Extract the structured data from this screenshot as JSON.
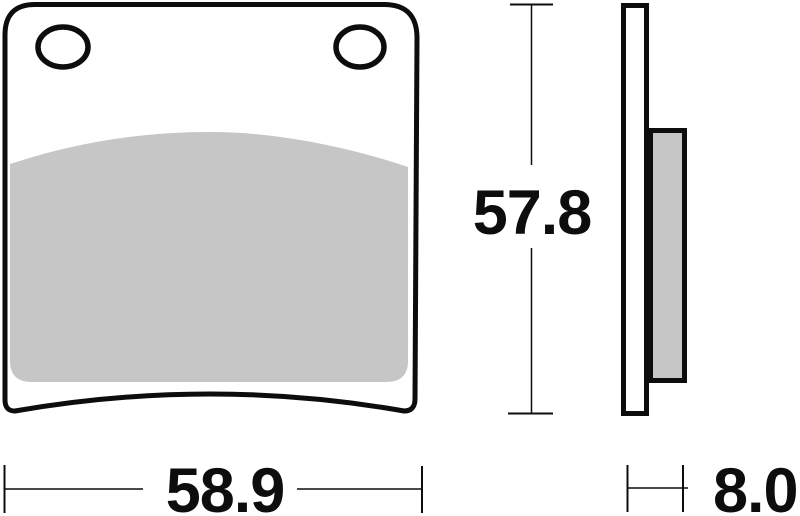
{
  "drawing": {
    "subject": "brake-pad-technical-drawing",
    "dimensions": {
      "width": "58.9",
      "height": "57.8",
      "thickness": "8.0"
    },
    "colors": {
      "line": "#0d0d0d",
      "friction_fill": "#c6c6c6",
      "background": "#ffffff"
    }
  }
}
